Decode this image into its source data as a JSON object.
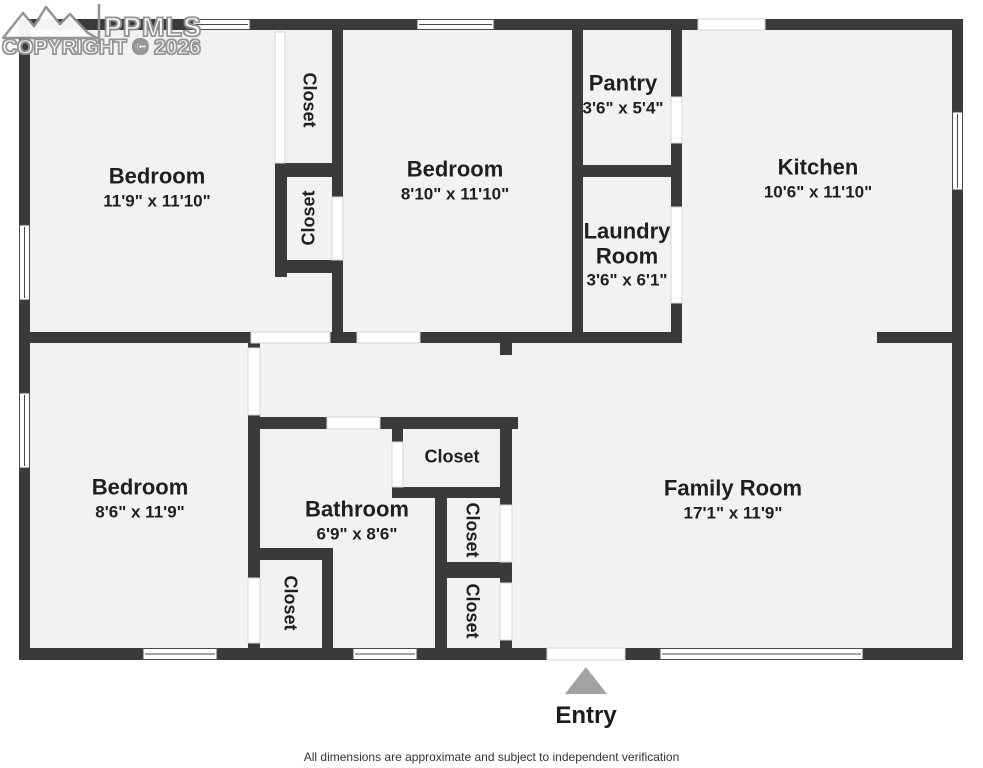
{
  "watermark": {
    "logo_text": "PPMLS",
    "copyright": "COPYRIGHT © 2026"
  },
  "rooms": {
    "bedroom_top_left": {
      "name": "Bedroom",
      "dims": "11'9\" x 11'10\""
    },
    "bedroom_center": {
      "name": "Bedroom",
      "dims": "8'10\" x 11'10\""
    },
    "pantry": {
      "name": "Pantry",
      "dims": "3'6\" x 5'4\""
    },
    "kitchen": {
      "name": "Kitchen",
      "dims": "10'6\" x 11'10\""
    },
    "laundry": {
      "name": "Laundry Room",
      "dims": "3'6\" x 6'1\""
    },
    "bedroom_bottom_left": {
      "name": "Bedroom",
      "dims": "8'6\" x 11'9\""
    },
    "bathroom": {
      "name": "Bathroom",
      "dims": "6'9\" x 8'6\""
    },
    "family_room": {
      "name": "Family Room",
      "dims": "17'1\" x 11'9\""
    }
  },
  "closet_labels": [
    "Closet",
    "Closet",
    "Closet",
    "Closet",
    "Closet",
    "Closet"
  ],
  "entry": {
    "label": "Entry"
  },
  "footer": {
    "disclaimer": "All dimensions are approximate and subject to independent verification"
  },
  "colors": {
    "wall": "#3a3a3c",
    "room_fill": "#f2f2f3",
    "entry_arrow": "#a3a3a3"
  }
}
